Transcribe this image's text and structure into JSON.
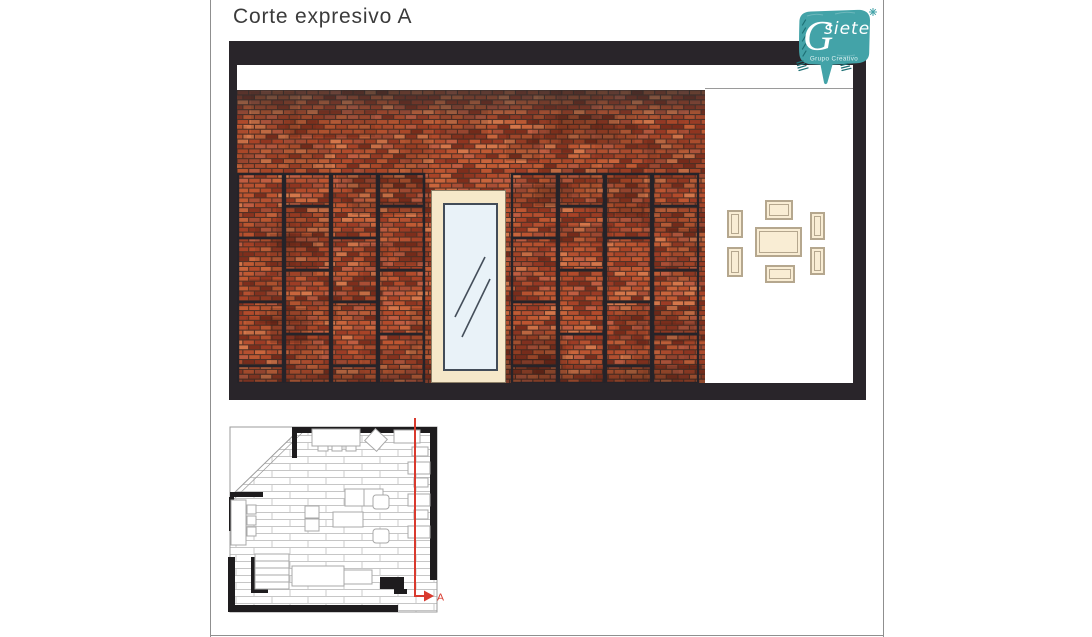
{
  "page": {
    "title": "Corte expresivo A"
  },
  "logo": {
    "brand_g": "G",
    "brand_rest": "siete",
    "tagline": "Grupo Creativo"
  },
  "plan": {
    "cut": {
      "label": "A"
    }
  },
  "elevation": {
    "wall": {
      "brick_palette": [
        "#a84327",
        "#b55030",
        "#c05a33",
        "#8f3520",
        "#c9653c",
        "#9c3c25",
        "#b34b2b",
        "#d4764a",
        "#7e2e1c",
        "#bd5531",
        "#aa4e35",
        "#c05d41"
      ],
      "mortar": "#5432266"
    }
  },
  "colors": {
    "sheet-border": "#8f8f8f",
    "title-color": "#3b3b3b",
    "frame-color": "#29252a",
    "mortar": "#543226",
    "panel-line": "#262329",
    "door-frame": "#f6e8c9",
    "door-glass": "#e9f2f8",
    "glass-line": "#454f5b",
    "gallery-fill": "#f9edd4",
    "gallery-border": "#b5a78e",
    "plan-wall": "#1e1c1e",
    "plan-outline": "#9b9b9b",
    "plan-joint": "#c6c6c6",
    "furn-line": "#a8a8a8",
    "cut-color": "#d93a2e",
    "logo-teal": "#43a3a8",
    "logo-hatch": "#1d6f74",
    "logo-text": "#ffffff"
  }
}
